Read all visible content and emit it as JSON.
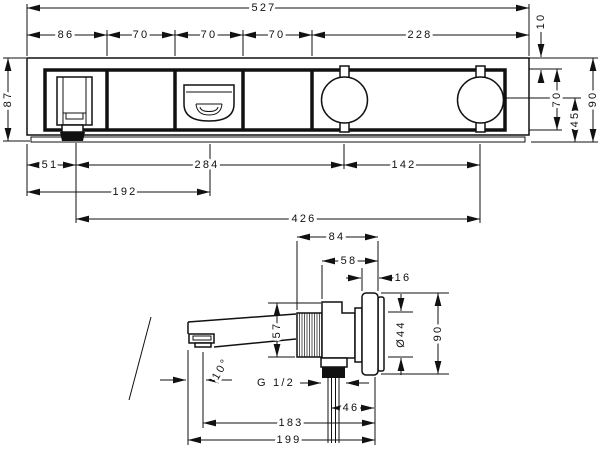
{
  "palette": {
    "background": "#ffffff",
    "line": "#111111"
  },
  "front_view": {
    "overall_width": "527",
    "seg_spout": "86",
    "seg_2": "70",
    "seg_3": "70",
    "seg_4": "70",
    "seg_handles": "228",
    "overall_height": "87",
    "top_inset": "10",
    "face_height": "70",
    "center_to_bottom": "45",
    "side_height": "90",
    "spout_offset": "51",
    "spout_to_handle1": "284",
    "handle_spacing": "142",
    "edge_to_diverter": "192",
    "spout_to_handle2": "426"
  },
  "side_view": {
    "depth_overall": "84",
    "depth_body": "58",
    "flange_depth": "16",
    "body_height": "57",
    "pipe_diameter": "Ø44",
    "flange_height": "90",
    "spout_angle": "10°",
    "thread_label": "G 1/2",
    "thread_span": "46",
    "outlet_to_wall": "183",
    "tip_to_wall": "199"
  }
}
